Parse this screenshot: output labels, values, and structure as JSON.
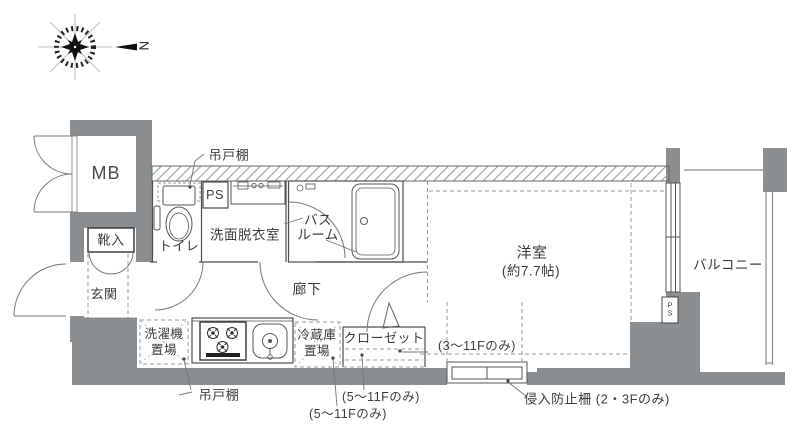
{
  "plan": {
    "compass_north": "N",
    "mb": "MB",
    "shoe_cabinet": "靴入",
    "entrance": "玄関",
    "toilet": "トイレ",
    "pipe_space_top": "PS",
    "washroom": "洗面脱衣室",
    "bath_line1": "バス",
    "bath_line2": "ルーム",
    "corridor": "廊下",
    "western_room": "洋室",
    "western_room_size": "(約7.7帖)",
    "balcony": "バルコニー",
    "closet": "クローゼット",
    "washer_line1": "洗濯機",
    "washer_line2": "置場",
    "fridge_line1": "冷蔵庫",
    "fridge_line2": "置場",
    "hanging_cupboard_top": "吊戸棚",
    "hanging_cupboard_bottom": "吊戸棚",
    "floors_3_11": "(3〜11Fのみ)",
    "floors_5_11_a": "(5〜11Fのみ)",
    "floors_5_11_b": "(5〜11Fのみ)",
    "intrusion_fence": "侵入防止柵 (2・3Fのみ)",
    "pipe_space_right_p": "P",
    "pipe_space_right_s": "S"
  },
  "colors": {
    "wall": "#8a8e91",
    "line": "#4e4e4e",
    "dashed": "#999999",
    "text": "#3b3b3b",
    "hatch": "#9aa0a3"
  }
}
